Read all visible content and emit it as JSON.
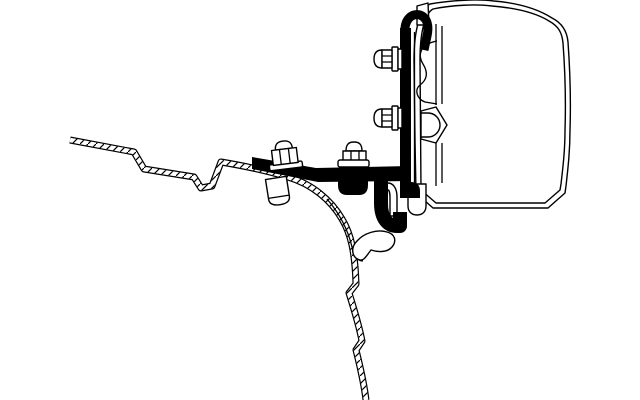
{
  "page": {
    "title": "Awning adapter bracket – technical drawing",
    "background_color": "#ffffff"
  },
  "illustration": {
    "description": "Black and white side-profile technical line drawing of an awning mounting adapter: a black steel bracket with hook arm is bolted to the hatched vehicle roof sheet-metal profile on the left and to the mounting rail of the awning cassette on the right.",
    "style": "technical line art",
    "colors": {
      "ink": "#000000",
      "paper": "#ffffff"
    },
    "parts": {
      "roof_profile": "vehicle roof cross-section (hatched sheet metal)",
      "adapter_bar": "black adapter bracket arm",
      "hook_arm": "J-hook arm of adapter",
      "mounting_plate": "vertical mounting plate with top hook",
      "awning_case": "awning cassette cross-section",
      "case_rail": "awning case mounting rail profile",
      "fasteners": "hex flange bolts, nut and spacer"
    }
  }
}
